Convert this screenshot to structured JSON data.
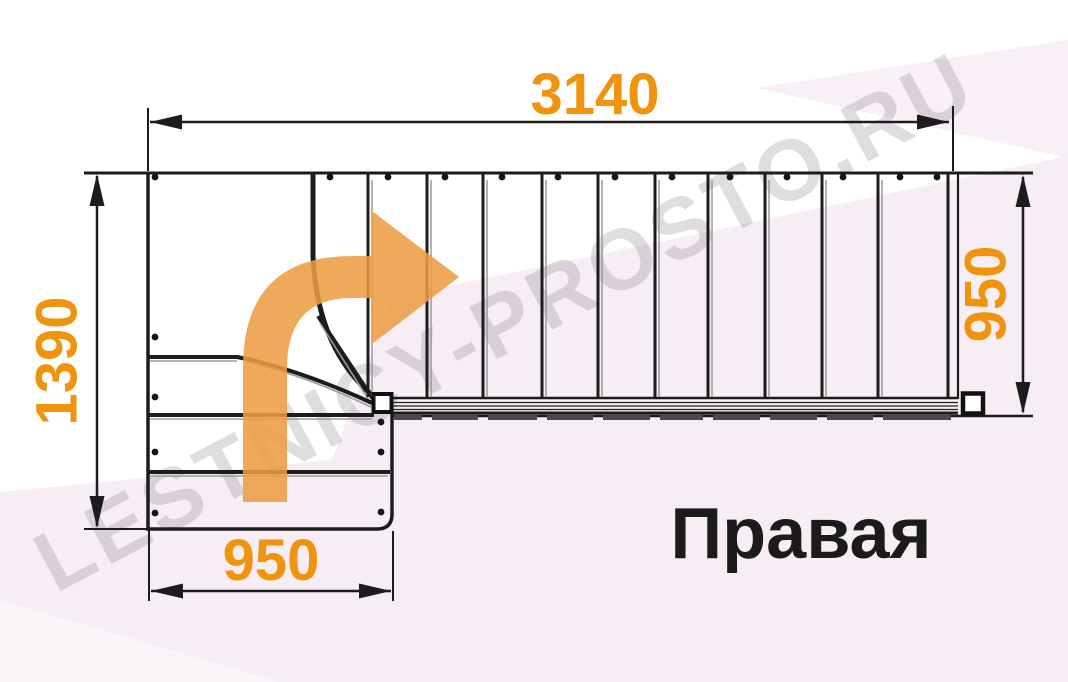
{
  "orientation_label": "Правая",
  "watermark": "LESTNICY-PROSTO.RU",
  "dimensions": {
    "top": {
      "value": "3140",
      "orientation": "horizontal"
    },
    "left": {
      "value": "1390",
      "orientation": "vertical"
    },
    "right": {
      "value": "950",
      "orientation": "vertical"
    },
    "bottom": {
      "value": "950",
      "orientation": "horizontal"
    }
  },
  "colors": {
    "dimension_text": "#F0930D",
    "arrow_fill": "#EC9C41",
    "line": "#1c1c1c",
    "line_shadow": "#9a9a9a",
    "tread_bar": "#4a4a4a",
    "background_tint": "#F7EDF5",
    "background_tint_light": "#FBF4F9"
  },
  "plan": {
    "upper_risers_x": [
      368,
      427,
      483,
      542,
      598,
      655,
      708,
      765,
      822,
      878
    ],
    "riser_top_y": 174,
    "riser_bottom_y": 397,
    "rail_start_x": 392,
    "rail_end_x": 958,
    "seg_end_x": 951,
    "seg_y": 414,
    "seg_h": 6,
    "dots_top": {
      "y": 177,
      "xs": [
        155,
        330,
        388,
        445,
        502,
        558,
        615,
        672,
        730,
        787,
        843,
        900,
        937
      ]
    },
    "dots_left": {
      "x": 155,
      "ys": [
        337,
        397,
        452,
        513
      ]
    },
    "dots_right": {
      "x": 381,
      "ys": [
        422,
        452,
        512
      ]
    },
    "lower_steps": [
      {
        "y": 357,
        "x1": 148,
        "x2": 239
      },
      {
        "y": 472,
        "x1": 148,
        "x2": 390
      }
    ]
  }
}
